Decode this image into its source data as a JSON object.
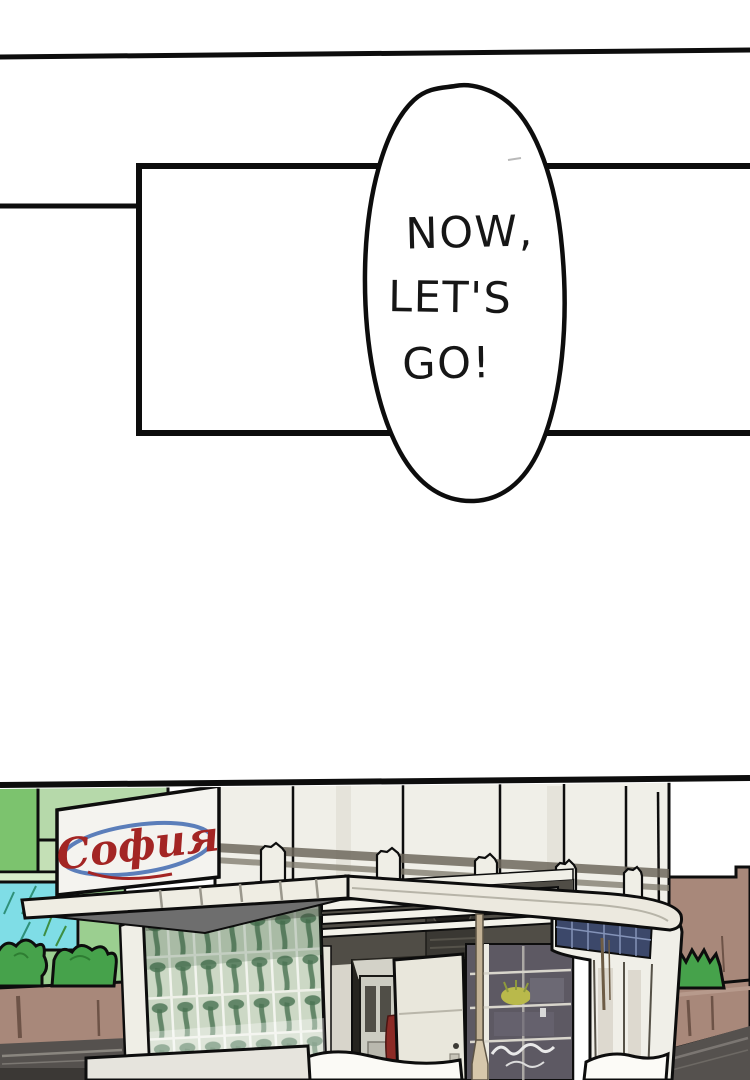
{
  "page": {
    "background": "#ffffff",
    "ink": "#0d0d0d"
  },
  "speech_bubble": {
    "lines": [
      "NOW,",
      "LET'S",
      "GO!"
    ],
    "text_color": "#161616",
    "fill": "#ffffff"
  },
  "storefront": {
    "sign_text": "София",
    "sign_text_color": "#a32524",
    "sign_swoosh_color": "#3f68b0",
    "palette": {
      "building_green_bright": "#7cc36e",
      "building_green_light": "#b6d9aa",
      "building_green_mid": "#9bcf90",
      "window_cyan": "#7fdde6",
      "bush_green": "#46a24b",
      "wall_brown": "#a8887a",
      "road_gray": "#55514e",
      "kiosk_white": "#f0efe8",
      "awning_underside": "#6e6e6e",
      "glass_pane": "#ccd8c5",
      "transom_blue": "#3c486a",
      "door_red": "#8c2b26"
    }
  }
}
